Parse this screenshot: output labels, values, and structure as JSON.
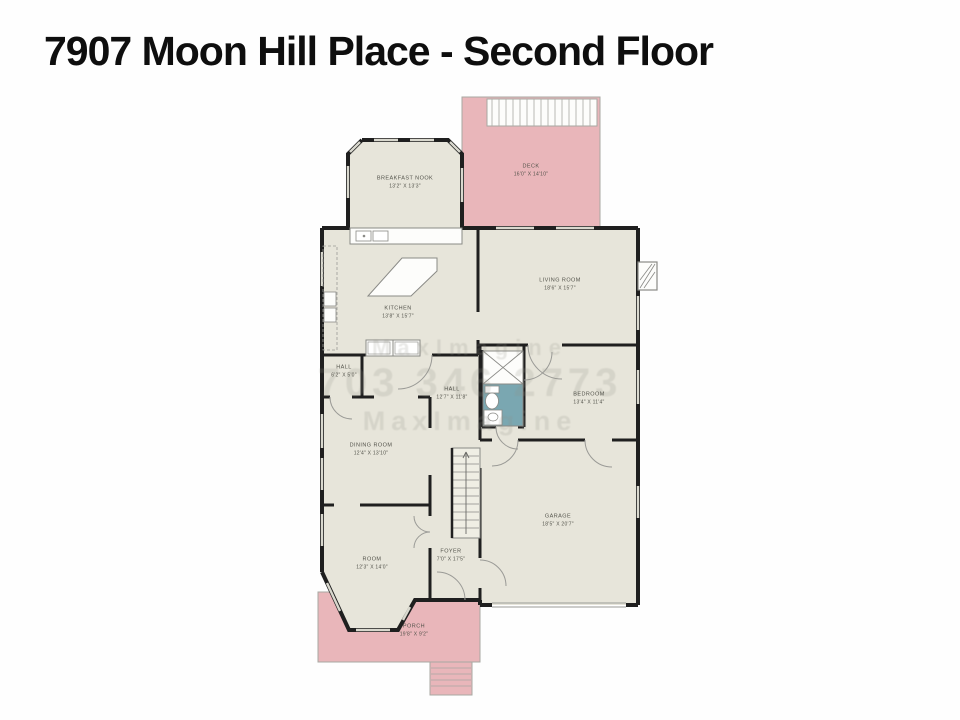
{
  "page": {
    "title": "7907 Moon Hill Place - Second Floor"
  },
  "watermark": {
    "line1": "MaxImagine",
    "line2": "703 346 2773",
    "line3": "MaxImagine"
  },
  "rooms": [
    {
      "name": "BREAKFAST NOOK",
      "dims": "13'2\" X 13'3\""
    },
    {
      "name": "DECK",
      "dims": "16'0\" X 14'10\""
    },
    {
      "name": "LIVING ROOM",
      "dims": "18'6\" X 15'7\""
    },
    {
      "name": "KITCHEN",
      "dims": "13'8\" X 15'7\""
    },
    {
      "name": "HALL",
      "dims": "6'2\" X 5'0\""
    },
    {
      "name": "HALL",
      "dims": "12'7\" X 11'8\""
    },
    {
      "name": "BEDROOM",
      "dims": "13'4\" X 11'4\""
    },
    {
      "name": "DINING ROOM",
      "dims": "12'4\" X 13'10\""
    },
    {
      "name": "GARAGE",
      "dims": "18'5\" X 20'7\""
    },
    {
      "name": "ROOM",
      "dims": "12'3\" X 14'0\""
    },
    {
      "name": "FOYER",
      "dims": "7'0\" X 17'5\""
    },
    {
      "name": "PORCH",
      "dims": "19'8\" X 9'2\""
    }
  ],
  "colors": {
    "floor": "#e7e5da",
    "exterior_pink": "#e9b6ba",
    "wall": "#1f1f1f",
    "bath_teal": "#7aa7b1"
  }
}
